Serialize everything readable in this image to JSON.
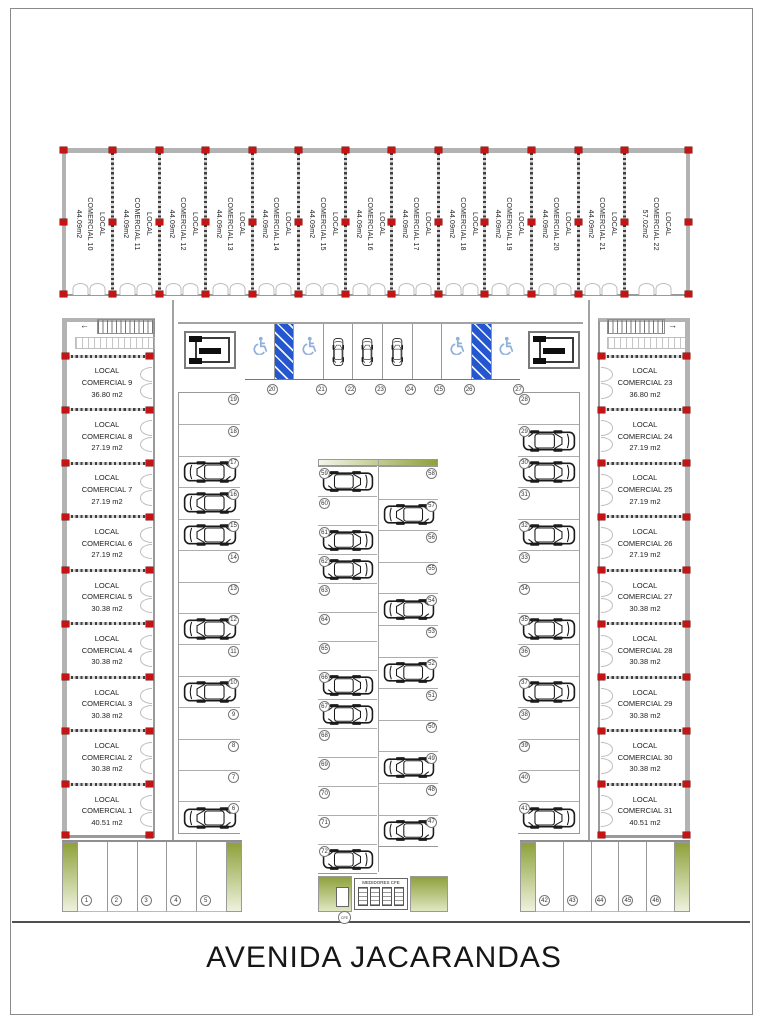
{
  "street": {
    "name": "AVENIDA JACARANDAS"
  },
  "meters": {
    "label": "MEDIDORES CFE",
    "badge": "CFE",
    "box_count": 4
  },
  "colors": {
    "marker_red": "#c41414",
    "handicap_blue": "#2456cf",
    "planter_green": "#8ea13b",
    "wall_gray": "#b3b3b3"
  },
  "locals": {
    "top": [
      {
        "name": "LOCAL COMERCIAL 10",
        "area": "44.09m2"
      },
      {
        "name": "LOCAL COMERCIAL 11",
        "area": "44.09m2"
      },
      {
        "name": "LOCAL COMERCIAL 12",
        "area": "44.09m2"
      },
      {
        "name": "LOCAL COMERCIAL 13",
        "area": "44.09m2"
      },
      {
        "name": "LOCAL COMERCIAL 14",
        "area": "44.09m2"
      },
      {
        "name": "LOCAL COMERCIAL 15",
        "area": "44.09m2"
      },
      {
        "name": "LOCAL COMERCIAL 16",
        "area": "44.09m2"
      },
      {
        "name": "LOCAL COMERCIAL 17",
        "area": "44.09m2"
      },
      {
        "name": "LOCAL COMERCIAL 18",
        "area": "44.09m2"
      },
      {
        "name": "LOCAL COMERCIAL 19",
        "area": "44.09m2"
      },
      {
        "name": "LOCAL COMERCIAL 20",
        "area": "44.09m2"
      },
      {
        "name": "LOCAL COMERCIAL 21",
        "area": "44.09m2"
      },
      {
        "name": "LOCAL COMERCIAL 22",
        "area": "57.02m2"
      }
    ],
    "left": [
      {
        "name": "LOCAL COMERCIAL 9",
        "area": "36.80 m2"
      },
      {
        "name": "LOCAL COMERCIAL 8",
        "area": "27.19 m2"
      },
      {
        "name": "LOCAL COMERCIAL 7",
        "area": "27.19 m2"
      },
      {
        "name": "LOCAL COMERCIAL 6",
        "area": "27.19 m2"
      },
      {
        "name": "LOCAL COMERCIAL 5",
        "area": "30.38 m2"
      },
      {
        "name": "LOCAL COMERCIAL 4",
        "area": "30.38 m2"
      },
      {
        "name": "LOCAL COMERCIAL 3",
        "area": "30.38 m2"
      },
      {
        "name": "LOCAL COMERCIAL 2",
        "area": "30.38 m2"
      },
      {
        "name": "LOCAL COMERCIAL 1",
        "area": "40.51 m2"
      }
    ],
    "right": [
      {
        "name": "LOCAL COMERCIAL 23",
        "area": "36.80 m2"
      },
      {
        "name": "LOCAL COMERCIAL 24",
        "area": "27.19 m2"
      },
      {
        "name": "LOCAL COMERCIAL 25",
        "area": "27.19 m2"
      },
      {
        "name": "LOCAL COMERCIAL 26",
        "area": "27.19 m2"
      },
      {
        "name": "LOCAL COMERCIAL 27",
        "area": "30.38 m2"
      },
      {
        "name": "LOCAL COMERCIAL 28",
        "area": "30.38 m2"
      },
      {
        "name": "LOCAL COMERCIAL 29",
        "area": "30.38 m2"
      },
      {
        "name": "LOCAL COMERCIAL 30",
        "area": "30.38 m2"
      },
      {
        "name": "LOCAL COMERCIAL 31",
        "area": "40.51 m2"
      }
    ]
  },
  "parking": {
    "top_row": [
      {
        "num": 20,
        "type": "handicap"
      },
      {
        "type": "aisle"
      },
      {
        "num": 21,
        "type": "handicap"
      },
      {
        "num": 22,
        "type": "car"
      },
      {
        "num": 23,
        "type": "car"
      },
      {
        "num": 24,
        "type": "car"
      },
      {
        "num": 25,
        "type": "empty"
      },
      {
        "num": 26,
        "type": "handicap"
      },
      {
        "type": "aisle"
      },
      {
        "num": 27,
        "type": "handicap"
      }
    ],
    "left_column": [
      {
        "num": 19,
        "car": false
      },
      {
        "num": 18,
        "car": false
      },
      {
        "num": 17,
        "car": true
      },
      {
        "num": 16,
        "car": true
      },
      {
        "num": 15,
        "car": true
      },
      {
        "num": 14,
        "car": false
      },
      {
        "num": 13,
        "car": false
      },
      {
        "num": 12,
        "car": true
      },
      {
        "num": 11,
        "car": false
      },
      {
        "num": 10,
        "car": true
      },
      {
        "num": 9,
        "car": false
      },
      {
        "num": 8,
        "car": false
      },
      {
        "num": 7,
        "car": false
      },
      {
        "num": 6,
        "car": true
      }
    ],
    "right_column": [
      {
        "num": 28,
        "car": false
      },
      {
        "num": 29,
        "car": true
      },
      {
        "num": 30,
        "car": true
      },
      {
        "num": 31,
        "car": false
      },
      {
        "num": 32,
        "car": true
      },
      {
        "num": 33,
        "car": false
      },
      {
        "num": 34,
        "car": false
      },
      {
        "num": 35,
        "car": true
      },
      {
        "num": 36,
        "car": false
      },
      {
        "num": 37,
        "car": true
      },
      {
        "num": 38,
        "car": false
      },
      {
        "num": 39,
        "car": false
      },
      {
        "num": 40,
        "car": false
      },
      {
        "num": 41,
        "car": true
      }
    ],
    "center_left_column": [
      {
        "num": 59,
        "car": true
      },
      {
        "num": 60,
        "car": false
      },
      {
        "num": 61,
        "car": true
      },
      {
        "num": 62,
        "car": true
      },
      {
        "num": 63,
        "car": false
      },
      {
        "num": 64,
        "car": false
      },
      {
        "num": 65,
        "car": false
      },
      {
        "num": 66,
        "car": true
      },
      {
        "num": 67,
        "car": true
      },
      {
        "num": 68,
        "car": false
      },
      {
        "num": 69,
        "car": false
      },
      {
        "num": 70,
        "car": false
      },
      {
        "num": 71,
        "car": false
      },
      {
        "num": 72,
        "car": true
      }
    ],
    "center_right_column": [
      {
        "num": 58,
        "car": false
      },
      {
        "num": 57,
        "car": true
      },
      {
        "num": 56,
        "car": false
      },
      {
        "num": 55,
        "car": false
      },
      {
        "num": 54,
        "car": true
      },
      {
        "num": 53,
        "car": false
      },
      {
        "num": 52,
        "car": true
      },
      {
        "num": 51,
        "car": false
      },
      {
        "num": 50,
        "car": false
      },
      {
        "num": 49,
        "car": true
      },
      {
        "num": 48,
        "car": false
      },
      {
        "num": 47,
        "car": true
      }
    ],
    "bottom_left_row": [
      {
        "num": 1
      },
      {
        "num": 2
      },
      {
        "num": 3
      },
      {
        "num": 4
      },
      {
        "num": 5
      }
    ],
    "bottom_right_row": [
      {
        "num": 42
      },
      {
        "num": 43
      },
      {
        "num": 44
      },
      {
        "num": 45
      },
      {
        "num": 46
      }
    ]
  }
}
